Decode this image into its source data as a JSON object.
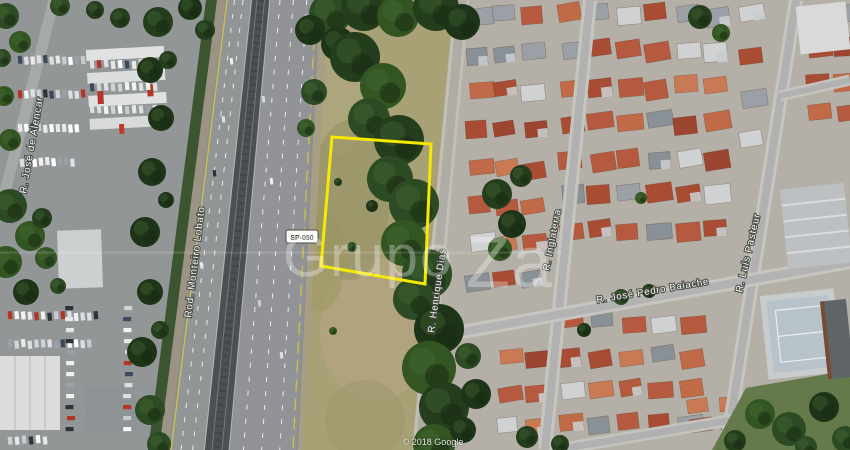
{
  "map": {
    "watermark": {
      "part1": "Grupo",
      "part2": "Za"
    },
    "attribution": "© 2018 Google",
    "road_shield_label": "SP-050",
    "streets": {
      "jose_de_alencar": "R. José de Alencar",
      "monteiro_lobato": "Rod. Monteiro Lobato",
      "henrique_dias": "R. Henrique Dias",
      "inglaterra": "R. Inglaterra",
      "jose_pedro_baiache": "R. José Pedro Baiache",
      "luis_pasteur": "R. Luís Pasteur"
    },
    "lot_outline_color": "#f7e800"
  }
}
